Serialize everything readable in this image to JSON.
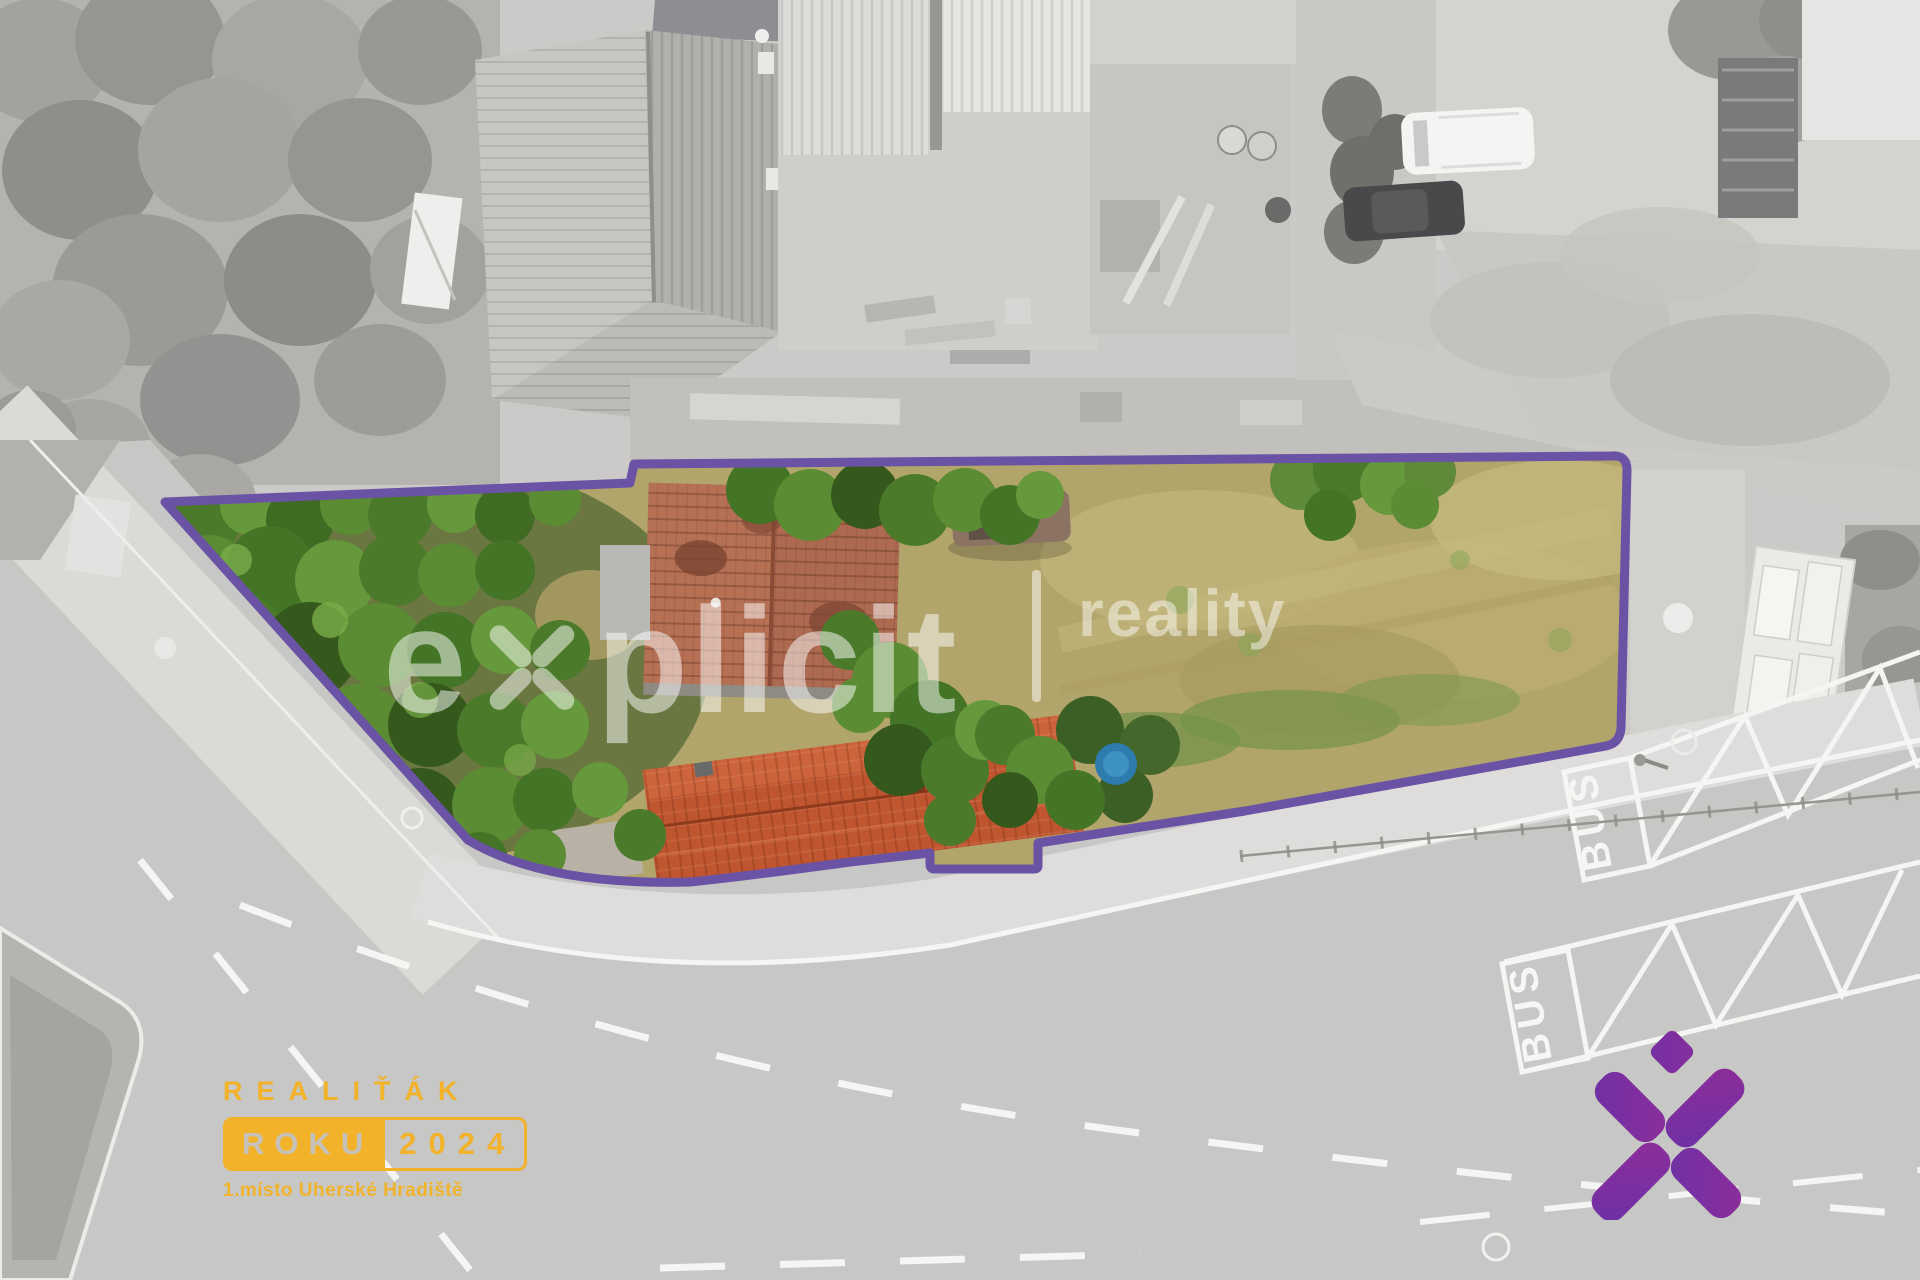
{
  "watermark": {
    "explicit_pre": "e",
    "explicit_post": "plicit",
    "reality": "reality",
    "opacity_note": "semi-transparent white"
  },
  "badge": {
    "title": "REALIŤÁK",
    "box_solid": "ROKU",
    "box_year": "2024",
    "subtitle": "1.místo Uherské Hradiště",
    "color": "#F2B32B"
  },
  "road": {
    "bus_labels": [
      "BUS",
      "BUS"
    ],
    "marking_color": "#f5f5f3"
  },
  "parcel": {
    "outline_color": "#6A52A5"
  },
  "logo": {
    "gradient_from": "#4A35B2",
    "gradient_to": "#A62A90"
  }
}
